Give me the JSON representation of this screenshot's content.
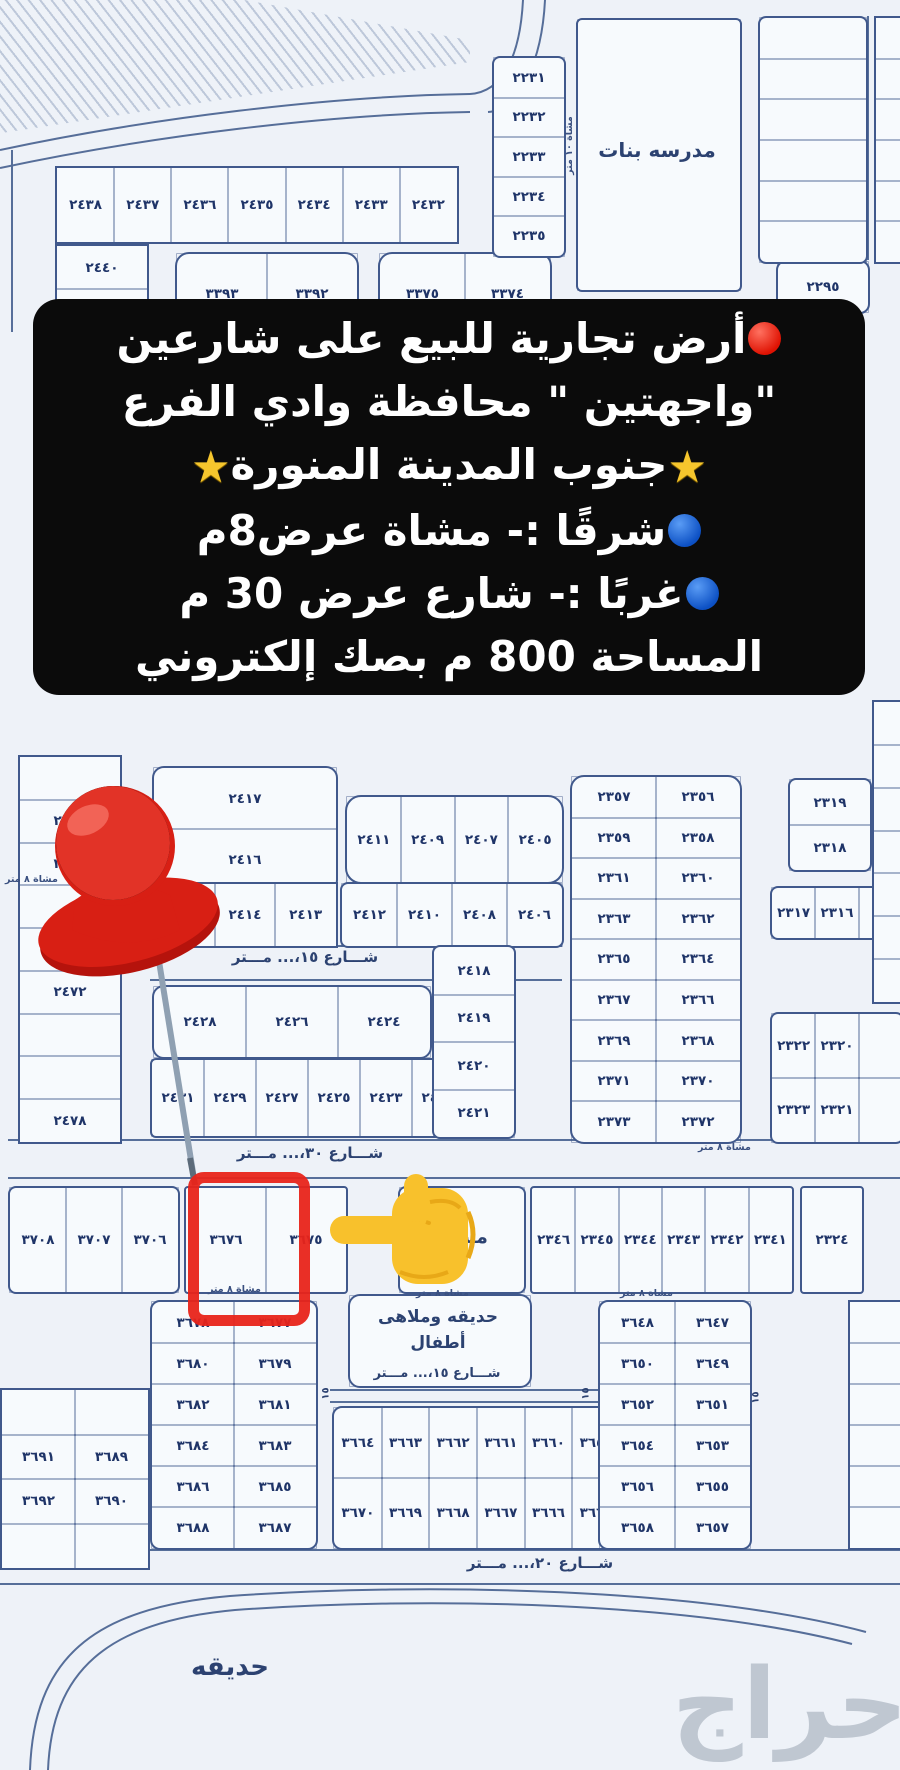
{
  "overlay": {
    "lines": [
      {
        "pre": "red-circle",
        "post": null,
        "text": "أرض تجارية للبيع على شارعين"
      },
      {
        "pre": null,
        "post": null,
        "text": "\"واجهتين \" محافظة وادي الفرع"
      },
      {
        "pre": "star",
        "post": "star",
        "text": "جنوب المدينة المنورة"
      },
      {
        "pre": "blue-circle",
        "post": null,
        "text": "شرقًا :- مشاة عرض8م"
      },
      {
        "pre": "blue-circle",
        "post": null,
        "text": "غربًا :- شارع عرض 30 م"
      },
      {
        "pre": null,
        "post": null,
        "text": "المساحة 800 م بصك إلكتروني"
      }
    ]
  },
  "map": {
    "landmarks": {
      "school": "مدرسه بنات",
      "mosque": "مسجد",
      "park_playground": "حديقه وملاهى أطفال",
      "park": "حديقه"
    },
    "street_labels": {
      "s15": "شـــارع ١٥،... مـــتر",
      "s30": "شـــارع ٣٠،... مـــتر",
      "s20": "شـــارع ٢٠،... مـــتر",
      "ped8": "مشاة ٨ متر",
      "ped10": "مشاة ١٠ متر",
      "w15": "١٥"
    },
    "blocks": {
      "top_row": [
        "٢٤٣٨",
        "٢٤٣٧",
        "٢٤٣٦",
        "٢٤٣٥",
        "٢٤٣٤",
        "٢٤٣٣",
        "٢٤٣٢"
      ],
      "left_col_top": [
        "٢٤٤٠",
        "٢٤٤٢"
      ],
      "blk3393": [
        "٣٣٩٣",
        "٣٣٩٢"
      ],
      "blk3375": [
        "٣٣٧٥",
        "٣٣٧٤"
      ],
      "plot2295": [
        "٢٢٩٥"
      ],
      "school_strip": [
        "٢٢٣١",
        "٢٢٣٢",
        "٢٢٣٣",
        "٢٢٣٤",
        "٢٢٣٥"
      ],
      "mid_left_col": [
        "",
        "٢٤٦٤",
        "٢٤٦٦",
        "",
        "",
        "٢٤٧٢",
        "",
        "",
        "٢٤٧٨"
      ],
      "blk2417": [
        "٢٤١٧",
        "٢٤١٦"
      ],
      "row2411": [
        "٢٤١١",
        "٢٤٠٩",
        "٢٤٠٧",
        "٢٤٠٥"
      ],
      "row2415a": [
        "٢٤١٥",
        "٢٤١٤",
        "٢٤١٣"
      ],
      "row2415b": [
        "٢٤١٢",
        "٢٤١٠",
        "٢٤٠٨",
        "٢٤٠٦"
      ],
      "row2428": [
        "٢٤٢٨",
        "٢٤٢٦",
        "٢٤٢٤"
      ],
      "row2431": [
        "٢٤٣١",
        "٢٤٢٩",
        "٢٤٢٧",
        "٢٤٢٥",
        "٢٤٢٣",
        "٢٤٢٢"
      ],
      "col2418": [
        "٢٤١٨",
        "٢٤١٩",
        "٢٤٢٠",
        "٢٤٢١"
      ],
      "pairs2356": [
        "٢٣٥٧",
        "٢٣٥٦",
        "٢٣٥٩",
        "٢٣٥٨",
        "٢٣٦١",
        "٢٣٦٠",
        "٢٣٦٣",
        "٢٣٦٢",
        "٢٣٦٥",
        "٢٣٦٤",
        "٢٣٦٧",
        "٢٣٦٦",
        "٢٣٦٩",
        "٢٣٦٨",
        "٢٣٧١",
        "٢٣٧٠",
        "٢٣٧٣",
        "٢٣٧٢"
      ],
      "col2319": [
        "٢٣١٩",
        "٢٣١٨"
      ],
      "row2317": [
        "٢٣١٧",
        "٢٣١٦",
        ""
      ],
      "rows2322": [
        "٢٣٢٢",
        "٢٣٢٠",
        "",
        "٢٣٢٣",
        "٢٣٢١",
        ""
      ],
      "row3708": [
        "٣٧٠٨",
        "٣٧٠٧",
        "٣٧٠٦"
      ],
      "row3676": [
        "٣٦٧٦",
        "٣٦٧٥"
      ],
      "row2346": [
        "٢٣٤٦",
        "٢٣٤٥",
        "٢٣٤٤",
        "٢٣٤٣",
        "٢٣٤٢",
        "٢٣٤١"
      ],
      "plot2324": [
        "٢٣٢٤"
      ],
      "bl_left": [
        "٣٦٧٨",
        "٣٦٧٧",
        "٣٦٨٠",
        "٣٦٧٩",
        "٣٦٨٢",
        "٣٦٨١",
        "٣٦٨٤",
        "٣٦٨٣",
        "٣٦٨٦",
        "٣٦٨٥",
        "٣٦٨٨",
        "٣٦٨٧"
      ],
      "bl_far_left": [
        "",
        "",
        "٣٦٩١",
        "٣٦٨٩",
        "٣٦٩٢",
        "٣٦٩٠",
        "",
        ""
      ],
      "bl_mid": [
        "٣٦٦٤",
        "٣٦٦٣",
        "٣٦٦٢",
        "٣٦٦١",
        "٣٦٦٠",
        "٣٦٥٩",
        "٣٦٧٠",
        "٣٦٦٩",
        "٣٦٦٨",
        "٣٦٦٧",
        "٣٦٦٦",
        "٣٦٦٥"
      ],
      "bl_right": [
        "٣٦٤٨",
        "٣٦٤٧",
        "٣٦٥٠",
        "٣٦٤٩",
        "٣٦٥٢",
        "٣٦٥١",
        "٣٦٥٤",
        "٣٦٥٣",
        "٣٦٥٦",
        "٣٦٥٥",
        "٣٦٥٨",
        "٣٦٥٧"
      ]
    }
  },
  "watermark": "حراج",
  "colors": {
    "overlay_bg": "#0b0b0b",
    "overlay_text": "#ffffff",
    "accent_red": "#e02a1e",
    "accent_blue": "#1a63d6",
    "accent_yellow": "#f6c62d",
    "map_line": "#41598c",
    "map_text": "#1f3468",
    "highlight_rect": "#e8241a"
  }
}
